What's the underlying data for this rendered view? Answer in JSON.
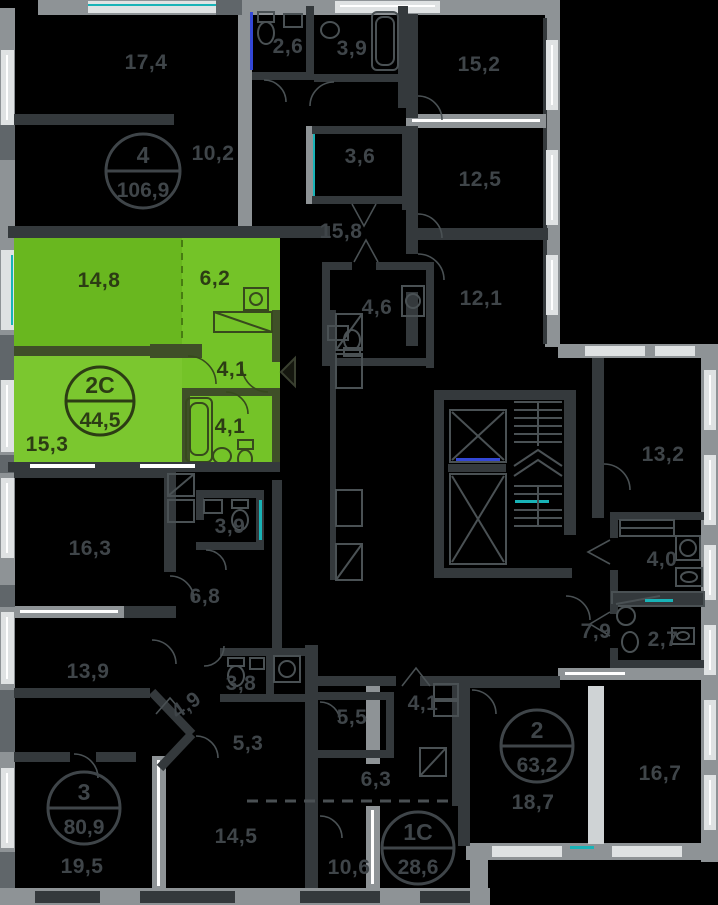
{
  "plan": {
    "colors": {
      "background": "#000000",
      "wall_outer": "#8e9396",
      "wall_inner": "#34393c",
      "window": "#dfe2e3",
      "teal_accent": "#18b3b7",
      "blue_accent": "#3347d6",
      "label": "#3f4549",
      "selected_fill": "#74c328",
      "selected_fill_dark": "#69b71f",
      "selected_fill_light": "#7bc72f",
      "selected_label": "#2c3c14"
    },
    "selected_apartment": {
      "badge_number": "2С",
      "badge_area": "44,5",
      "rooms": [
        {
          "area": "14,8"
        },
        {
          "area": "6,2"
        },
        {
          "area": "4,1"
        },
        {
          "area": "4,1"
        },
        {
          "area": "15,3"
        }
      ]
    },
    "labels": [
      {
        "text": "17,4",
        "x": 146,
        "y": 62,
        "ctx": "dark"
      },
      {
        "text": "10,2",
        "x": 213,
        "y": 153,
        "ctx": "dark"
      },
      {
        "text": "2,6",
        "x": 288,
        "y": 46,
        "ctx": "dark"
      },
      {
        "text": "3,9",
        "x": 352,
        "y": 48,
        "ctx": "dark"
      },
      {
        "text": "15,8",
        "x": 341,
        "y": 231,
        "ctx": "dark"
      },
      {
        "text": "3,6",
        "x": 360,
        "y": 156,
        "ctx": "dark"
      },
      {
        "text": "15,2",
        "x": 479,
        "y": 64,
        "ctx": "dark"
      },
      {
        "text": "12,5",
        "x": 480,
        "y": 179,
        "ctx": "dark"
      },
      {
        "text": "12,1",
        "x": 481,
        "y": 298,
        "ctx": "dark"
      },
      {
        "text": "4,6",
        "x": 377,
        "y": 307,
        "ctx": "dark"
      },
      {
        "text": "14,8",
        "x": 99,
        "y": 280,
        "ctx": "green"
      },
      {
        "text": "6,2",
        "x": 215,
        "y": 278,
        "ctx": "green"
      },
      {
        "text": "4,1",
        "x": 232,
        "y": 369,
        "ctx": "green"
      },
      {
        "text": "4,1",
        "x": 230,
        "y": 426,
        "ctx": "green"
      },
      {
        "text": "15,3",
        "x": 47,
        "y": 444,
        "ctx": "green"
      },
      {
        "text": "13,2",
        "x": 663,
        "y": 454,
        "ctx": "dark"
      },
      {
        "text": "4,0",
        "x": 662,
        "y": 559,
        "ctx": "dark"
      },
      {
        "text": "7,9",
        "x": 596,
        "y": 631,
        "ctx": "dark"
      },
      {
        "text": "2,7",
        "x": 663,
        "y": 639,
        "ctx": "dark"
      },
      {
        "text": "16,7",
        "x": 660,
        "y": 773,
        "ctx": "dark"
      },
      {
        "text": "18,7",
        "x": 533,
        "y": 802,
        "ctx": "dark"
      },
      {
        "text": "16,3",
        "x": 90,
        "y": 548,
        "ctx": "dark"
      },
      {
        "text": "3,9",
        "x": 230,
        "y": 526,
        "ctx": "dark"
      },
      {
        "text": "6,8",
        "x": 205,
        "y": 596,
        "ctx": "dark"
      },
      {
        "text": "13,9",
        "x": 88,
        "y": 671,
        "ctx": "dark"
      },
      {
        "text": "3,8",
        "x": 241,
        "y": 683,
        "ctx": "dark"
      },
      {
        "text": "4,9",
        "x": 186,
        "y": 705,
        "ctx": "dark",
        "rot": -35
      },
      {
        "text": "5,3",
        "x": 248,
        "y": 743,
        "ctx": "dark"
      },
      {
        "text": "14,5",
        "x": 236,
        "y": 836,
        "ctx": "dark"
      },
      {
        "text": "19,5",
        "x": 82,
        "y": 866,
        "ctx": "dark"
      },
      {
        "text": "5,5",
        "x": 352,
        "y": 717,
        "ctx": "dark"
      },
      {
        "text": "4,1",
        "x": 423,
        "y": 703,
        "ctx": "dark"
      },
      {
        "text": "6,3",
        "x": 376,
        "y": 779,
        "ctx": "dark"
      },
      {
        "text": "10,6",
        "x": 349,
        "y": 867,
        "ctx": "dark"
      }
    ],
    "badges": [
      {
        "number": "4",
        "area": "106,9",
        "cx": 143,
        "cy": 171,
        "r": 37,
        "selected": false
      },
      {
        "number": "2С",
        "area": "44,5",
        "cx": 100,
        "cy": 401,
        "r": 34,
        "selected": true
      },
      {
        "number": "3",
        "area": "80,9",
        "cx": 84,
        "cy": 808,
        "r": 36,
        "selected": false
      },
      {
        "number": "2",
        "area": "63,2",
        "cx": 537,
        "cy": 746,
        "r": 36,
        "selected": false
      },
      {
        "number": "1С",
        "area": "28,6",
        "cx": 418,
        "cy": 848,
        "r": 36,
        "selected": false
      }
    ]
  }
}
